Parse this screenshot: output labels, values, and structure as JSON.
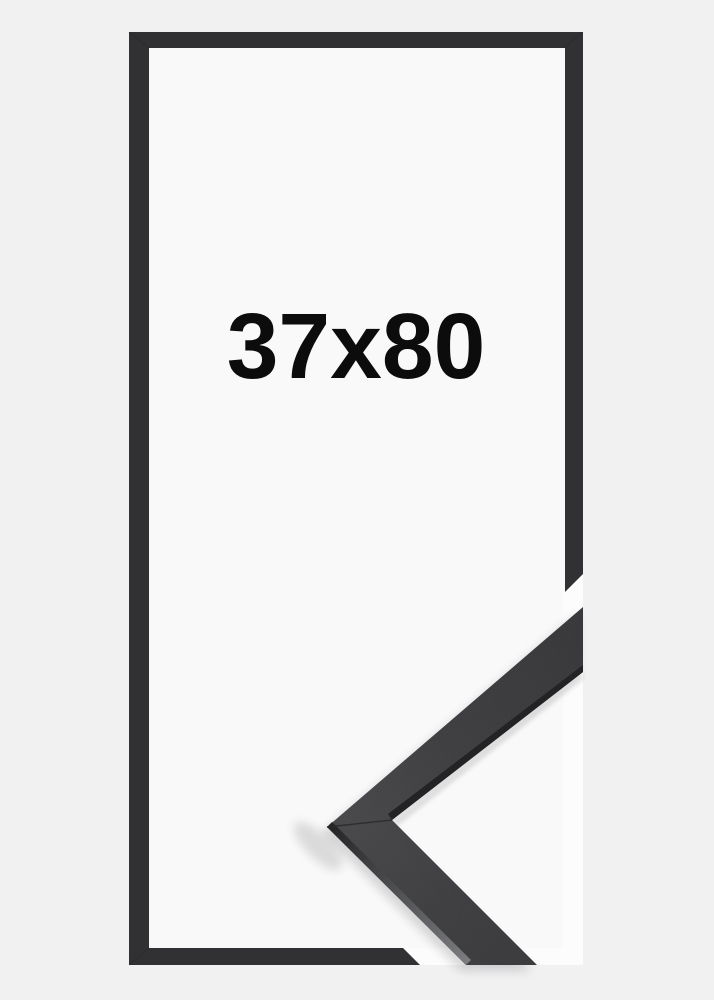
{
  "product": {
    "size_label": "37x80"
  },
  "icons": {
    "frame_corner_sample": "mitered-corner-of-black-frame-moulding"
  },
  "colors": {
    "page_background": "#f1f1f2",
    "frame_front": "#313134",
    "frame_opening": "#f9f9fa",
    "corner_photo_backdrop": "#fcfcfd",
    "label_text": "#0c0c0c",
    "moulding_face": "#3a3a3d",
    "moulding_edge_dark": "#1e1e20",
    "moulding_edge_light": "#77787b"
  }
}
